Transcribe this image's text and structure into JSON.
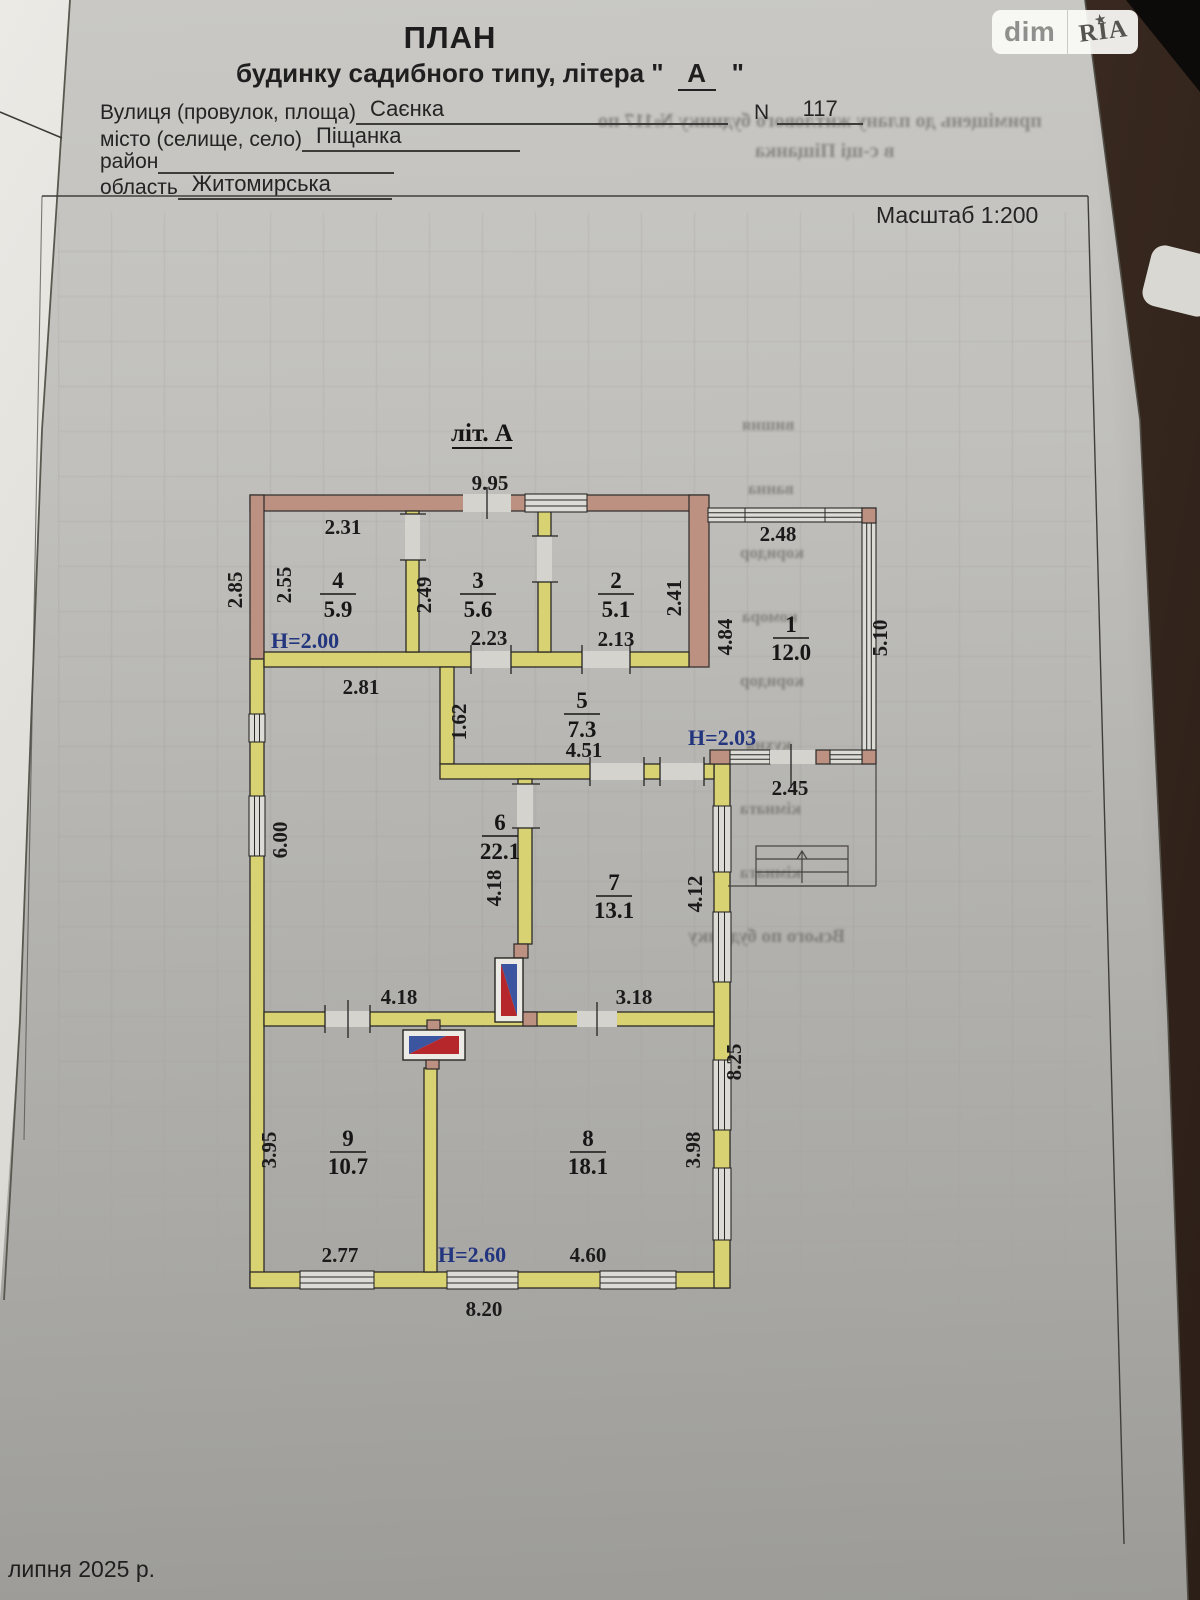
{
  "header": {
    "title": "ПЛАН",
    "subtitle_prefix": "будинку садибного типу, літера \"",
    "letter": "А",
    "subtitle_suffix": "\"",
    "scale": "Масштаб 1:200",
    "fields": [
      {
        "label": "Вулиця (провулок, площа)",
        "value": "Саєнка",
        "n_label": "N",
        "n_value": "117"
      },
      {
        "label": "місто (селище, село)",
        "value": "Піщанка"
      },
      {
        "label": "район",
        "value": ""
      },
      {
        "label": "область",
        "value": "Житомирська"
      }
    ]
  },
  "watermark": {
    "dim": "dim",
    "ria": "RIA",
    "star": "★"
  },
  "meta": {
    "date_note": "липня 2025 р."
  },
  "plan": {
    "caption": "літ. А",
    "rooms": {
      "r1": {
        "num": "1",
        "area": "12.0"
      },
      "r2": {
        "num": "2",
        "area": "5.1"
      },
      "r3": {
        "num": "3",
        "area": "5.6"
      },
      "r4": {
        "num": "4",
        "area": "5.9"
      },
      "r5": {
        "num": "5",
        "area": "7.3"
      },
      "r6": {
        "num": "6",
        "area": "22.1"
      },
      "r7": {
        "num": "7",
        "area": "13.1"
      },
      "r8": {
        "num": "8",
        "area": "18.1"
      },
      "r9": {
        "num": "9",
        "area": "10.7"
      }
    },
    "dims": {
      "top_width": "9.95",
      "room4_width": "2.31",
      "outer_left_height": "2.85",
      "room4_height": "2.55",
      "room3_height": "2.49",
      "room3_width": "2.23",
      "room2_width": "2.13",
      "room2_height": "2.41",
      "veranda_width": "2.48",
      "veranda_left_height": "4.84",
      "veranda_right_height": "5.10",
      "veranda_door_width": "2.45",
      "room6_top_width": "2.81",
      "room5_left_height": "1.62",
      "room5_width": "4.51",
      "room6_left_height": "6.00",
      "room6_right_height": "4.18",
      "room7_height": "4.12",
      "room6_bottom_width": "4.18",
      "room7_bottom_width": "3.18",
      "right_outer_height": "8.25",
      "room8_height": "3.98",
      "room9_height": "3.95",
      "room9_width": "2.77",
      "room8_width": "4.60",
      "bottom_width": "8.20"
    },
    "heights": {
      "h200": "Н=2.00",
      "h203": "Н=2.03",
      "h260": "Н=2.60"
    }
  },
  "bleedthrough": {
    "line1": "приміщень до плану житлового будинку №117 по",
    "line2": "в с-щі Піщанка",
    "col": [
      "вишня",
      "ванна",
      "коридор",
      "комора",
      "коридор",
      "кухня",
      "кімната",
      "кімната"
    ],
    "footer": "Всього по будинку"
  }
}
